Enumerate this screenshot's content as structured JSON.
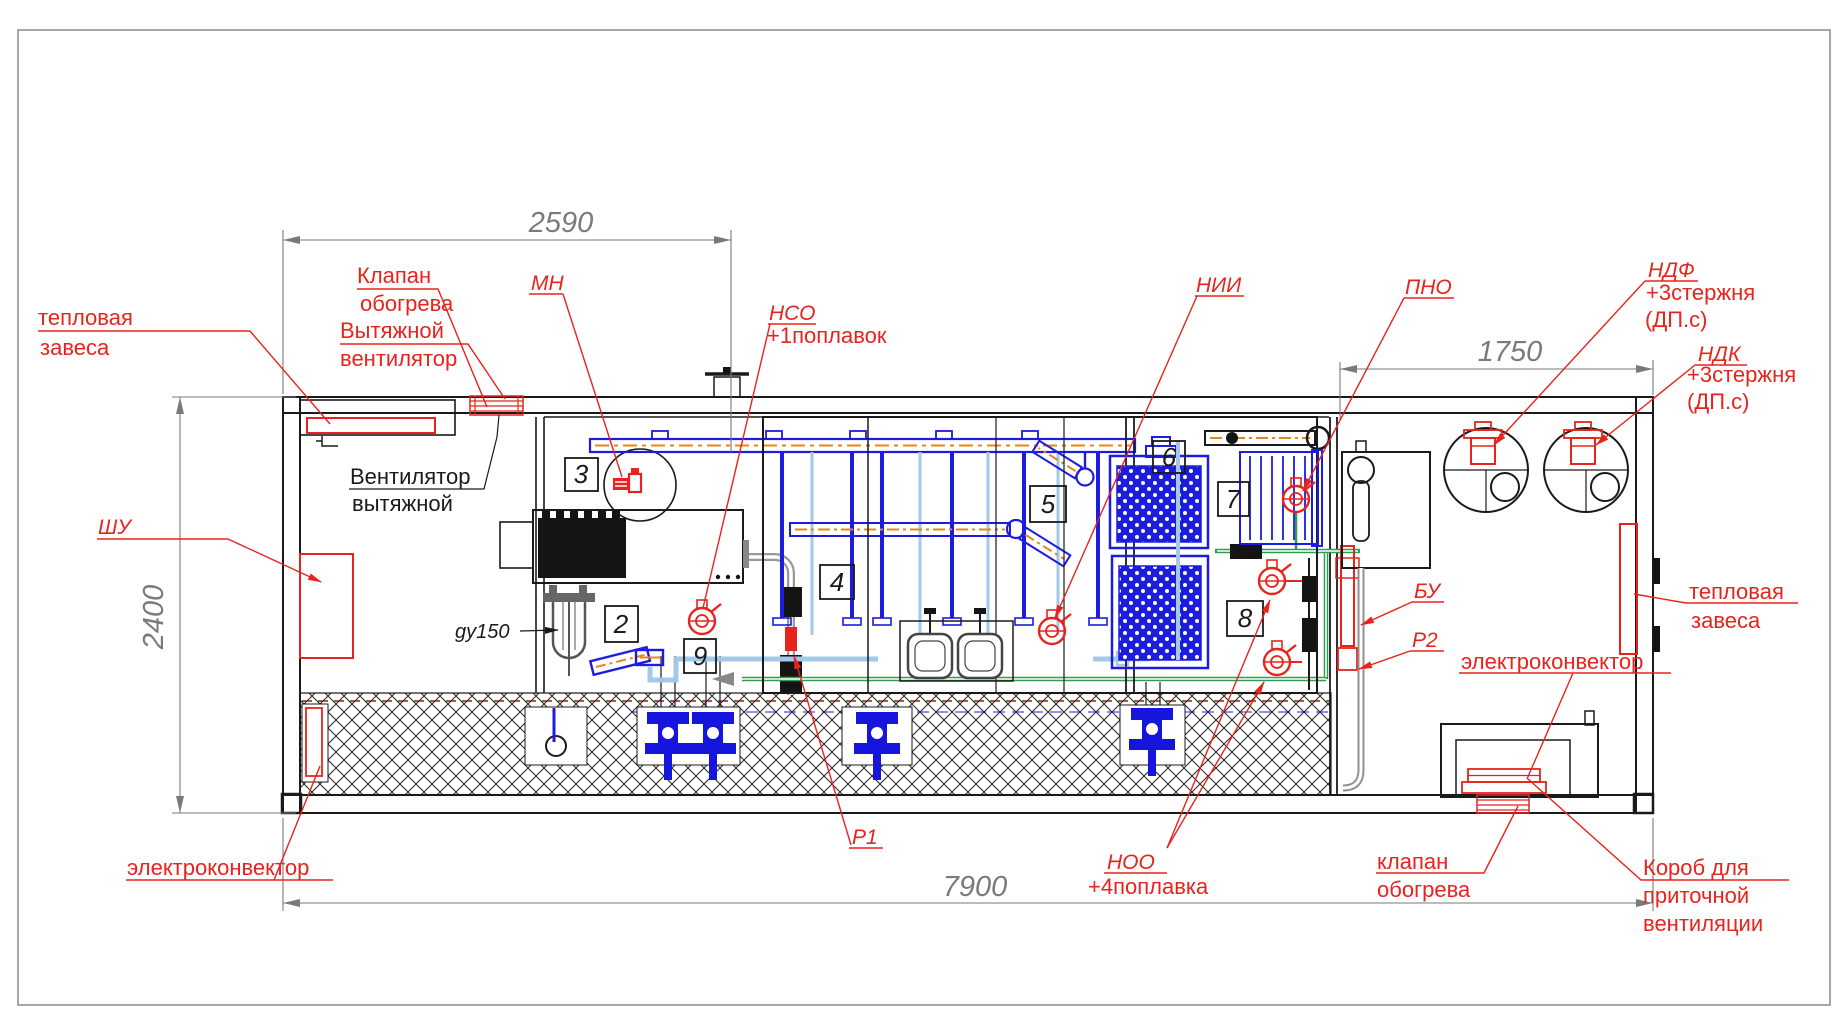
{
  "dimensions": {
    "top_width": "2590",
    "right_width": "1750",
    "height": "2400",
    "total_width": "7900"
  },
  "equipment_numbers": {
    "n2": "2",
    "n3": "3",
    "n4": "4",
    "n5": "5",
    "n6": "6",
    "n7": "7",
    "n8": "8",
    "n9": "9"
  },
  "labels": {
    "heat_curtain_left": {
      "l1": "тепловая",
      "l2": "завеса"
    },
    "heating_valve_top": {
      "l1": "Клапан",
      "l2": "обогрева"
    },
    "exhaust_fan_red": {
      "l1": "Вытяжной",
      "l2": "вентилятор"
    },
    "exhaust_fan_black": {
      "l1": "Вентилятор",
      "l2": "вытяжной"
    },
    "mn": "МН",
    "nso": "НСО",
    "nso_note": "+1поплавок",
    "nii": "НИИ",
    "pno": "ПНО",
    "ndf": "НДФ",
    "ndf_note1": "+3стержня",
    "ndf_note2": "(ДП.с)",
    "ndk": "НДК",
    "ndk_note1": "+3стержня",
    "ndk_note2": "(ДП.с)",
    "shu": "ШУ",
    "bu": "БУ",
    "r2": "Р2",
    "r1": "Р1",
    "noo": "НОО",
    "noo_note": "+4поплавка",
    "gy150": "gy150",
    "heat_curtain_right": {
      "l1": "тепловая",
      "l2": "завеса"
    },
    "electroconvector_left": "электроконвектор",
    "electroconvector_right": "электроконвектор",
    "heating_valve_bottom": {
      "l1": "клапан",
      "l2": "обогрева"
    },
    "supply_vent_duct": {
      "l1": "Короб для",
      "l2": "приточной",
      "l3": "вентиляции"
    }
  },
  "colors": {
    "annotation_red": "#e8231d",
    "pipe_blue": "#1c1ce0",
    "pipe_light_blue": "#a3c8e8",
    "pipe_orange": "#e8861e",
    "pipe_green": "#2f9e52",
    "dimension_gray": "#7a7a7a",
    "line_black": "#1a1a1a"
  }
}
